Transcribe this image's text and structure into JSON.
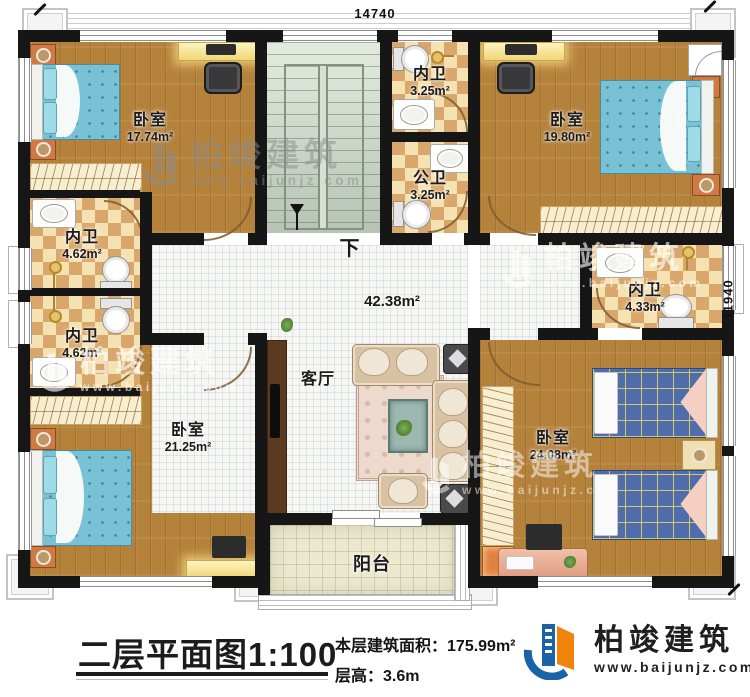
{
  "dimensions": {
    "width_mm": "14740",
    "height_mm": "11940"
  },
  "rooms": {
    "bedroom_tl": {
      "label": "卧室",
      "area": "17.74m²"
    },
    "bath_tl": {
      "label": "内卫",
      "area": "4.62m²"
    },
    "bath_bl": {
      "label": "内卫",
      "area": "4.62m²"
    },
    "bedroom_bl": {
      "label": "卧室",
      "area": "21.25m²"
    },
    "bath_top": {
      "label": "内卫",
      "area": "3.25m²"
    },
    "bath_public": {
      "label": "公卫",
      "area": "3.25m²"
    },
    "bedroom_tr": {
      "label": "卧室",
      "area": "19.80m²"
    },
    "bath_r": {
      "label": "内卫",
      "area": "4.33m²"
    },
    "living": {
      "label": "客厅",
      "area": "42.38m²"
    },
    "bedroom_br": {
      "label": "卧室",
      "area": "24.08m²"
    },
    "balcony": {
      "label": "阳台"
    },
    "stairs": {
      "down_label": "下"
    }
  },
  "caption": {
    "title": "二层平面图1:100",
    "area_label": "本层建筑面积：",
    "area_value": "175.99m²",
    "floor_height_label": "层高：",
    "floor_height_value": "3.6m"
  },
  "brand": {
    "name": "柏竣建筑",
    "url": "www.baijunjz.com"
  },
  "watermark": {
    "name": "柏竣建筑",
    "url": "www.baijunjz.com"
  },
  "colors": {
    "brand_blue": "#1b63a8",
    "brand_orange": "#f0830a",
    "wall": "#161616"
  }
}
